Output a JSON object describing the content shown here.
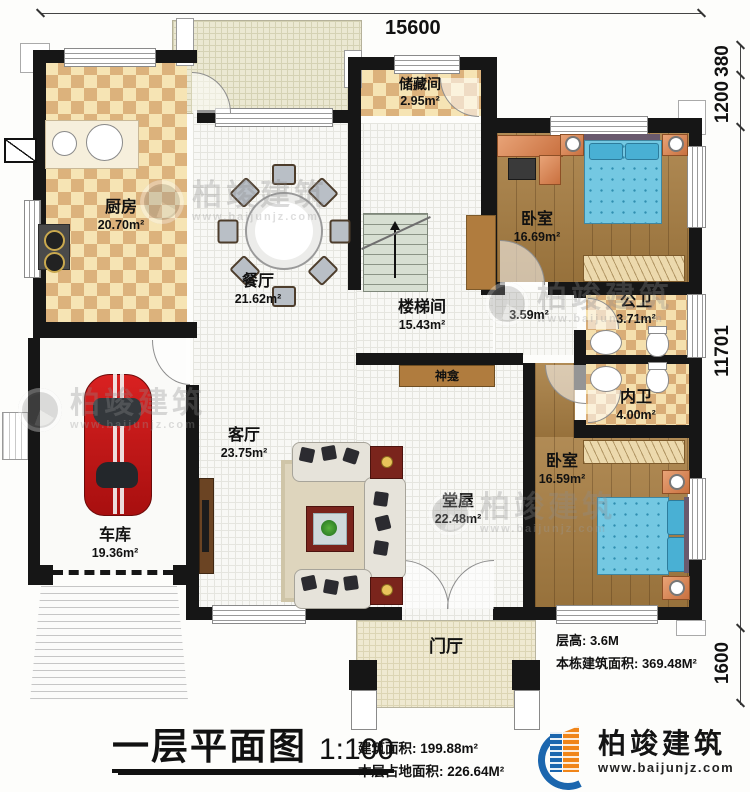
{
  "plan": {
    "rooms": {
      "kitchen": {
        "name": "厨房",
        "area": "20.70m²"
      },
      "storage": {
        "name": "储藏间",
        "area": "2.95m²"
      },
      "dining": {
        "name": "餐厅",
        "area": "21.62m²"
      },
      "bedroom1": {
        "name": "卧室",
        "area": "16.69m²"
      },
      "stairwell": {
        "name": "楼梯间",
        "area": "15.43m²"
      },
      "corridor": {
        "area": "3.59m²"
      },
      "public_bath": {
        "name": "公卫",
        "area": "3.71m²"
      },
      "private_bath": {
        "name": "内卫",
        "area": "4.00m²"
      },
      "shrine": {
        "name": "神龛"
      },
      "living": {
        "name": "客厅",
        "area": "23.75m²"
      },
      "hall": {
        "name": "堂屋",
        "area": "22.48m²"
      },
      "bedroom2": {
        "name": "卧室",
        "area": "16.59m²"
      },
      "garage": {
        "name": "车库",
        "area": "19.36m²"
      },
      "foyer": {
        "name": "门厅"
      }
    },
    "dimensions": {
      "top": "15600",
      "right": [
        "380",
        "1200",
        "11701",
        "1600"
      ]
    },
    "notes": {
      "floor_height": "层高: 3.6M",
      "building_total_area": "本栋建筑面积: 369.48M²"
    }
  },
  "title_block": {
    "title": "一层平面图",
    "scale": "1:100",
    "floor_area": "建筑面积: 199.88m²",
    "footprint_area": "本层占地面积: 226.64M²"
  },
  "brand": {
    "name": "柏竣建筑",
    "url": "www.baijunjz.com",
    "blue": "#1b66ae",
    "orange": "#f08519"
  }
}
